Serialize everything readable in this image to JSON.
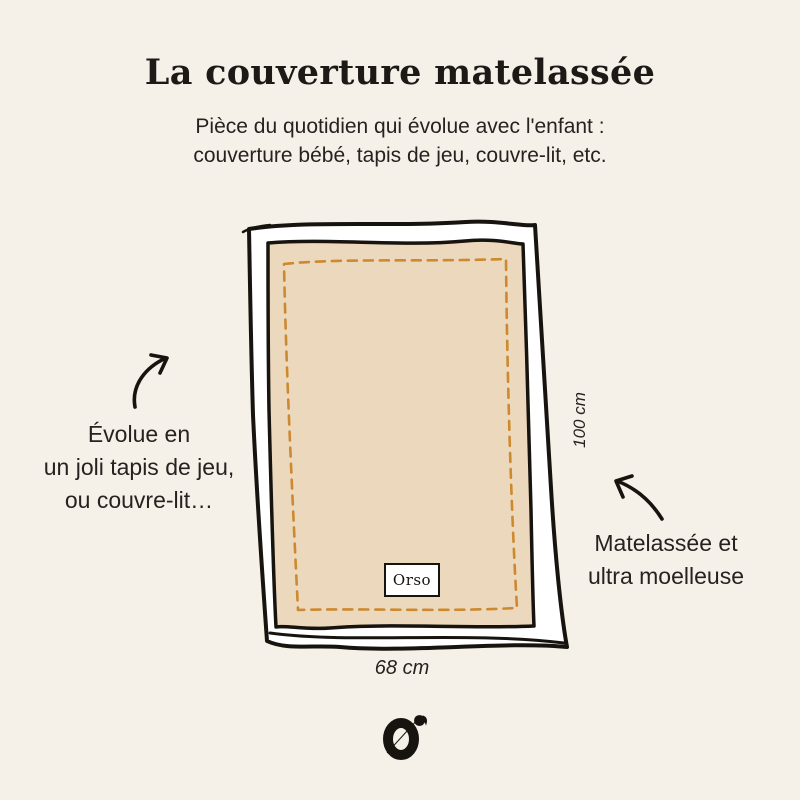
{
  "page": {
    "background_color": "#f5f1e8",
    "text_color": "#262220"
  },
  "header": {
    "title": "La couverture matelassée",
    "subtitle": {
      "line1": "Pièce du quotidien qui évolue avec l'enfant :",
      "line2": "couverture bébé, tapis de jeu, couvre-lit, etc."
    }
  },
  "diagram": {
    "blanket": {
      "brand_tag": "Orso",
      "fill_color": "#ecd9bd",
      "border_color": "#ffffff",
      "outline_color": "#17130f",
      "stitch_color": "#cd8930",
      "width_label": "68 cm",
      "height_label": "100 cm"
    },
    "left_annotation": {
      "line1": "Évolue en",
      "line2": "un joli tapis de jeu,",
      "line3": "ou couvre-lit…"
    },
    "right_annotation": {
      "line1": "Matelassée et",
      "line2": "ultra moelleuse"
    }
  },
  "footer": {
    "logo_icon": "orso-monogram"
  }
}
